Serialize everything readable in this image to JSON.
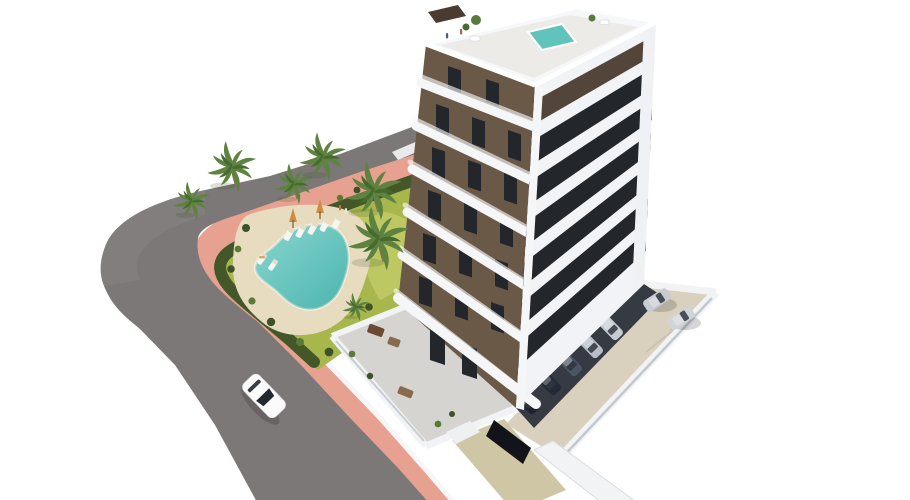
{
  "scene": {
    "title": "Aerial 3D architectural rendering of a modern apartment tower",
    "description": "White multi-storey residential building with brown balcony facade, rooftop plunge pool, landscaped garden with free-form swimming pool, sun loungers and palm trees, curved asphalt road with pink sidewalk, white car driving, residents parking court with parked cars and garage ramp",
    "view": "high-angle three-quarter aerial",
    "background": "plain white"
  },
  "inventory": {
    "building_floors_visible": 8,
    "balcony_levels": 6,
    "palm_trees": 7,
    "sun_loungers": 7,
    "parasols": 2,
    "parked_cars": 7,
    "moving_cars": 1,
    "pools": 2,
    "people_visible": 6
  },
  "colors": {
    "road_asphalt": "#7b7877",
    "curb_white": "#f6f6f6",
    "sidewalk_pink": "#e7a190",
    "lawn_green": "#a8b74c",
    "lawn_light": "#c2cc69",
    "hedge_green": "#445729",
    "pool_water": "#62c3bd",
    "pool_deck_sand": "#e8dcc0",
    "facade_brown": "#6b5948",
    "facade_white": "#f2f3f6",
    "window_glass": "#23262b",
    "attic_brown": "#54453a",
    "slab_white": "#f5f6f8",
    "parking_concrete": "#d9d0be",
    "parking_shadow": "#363b43",
    "ramp_beige": "#cfc6a6",
    "garage_dark": "#121419",
    "wall_white": "#f0f1f4",
    "terrace_floor": "#d6d4d0",
    "car_white": "#fbfbfb",
    "car_silver": "#c7ccd2",
    "car_dark": "#232937",
    "umbrella_orange": "#cf8c41",
    "palm_green": "#5e8340",
    "palm_trunk": "#8a7254"
  }
}
